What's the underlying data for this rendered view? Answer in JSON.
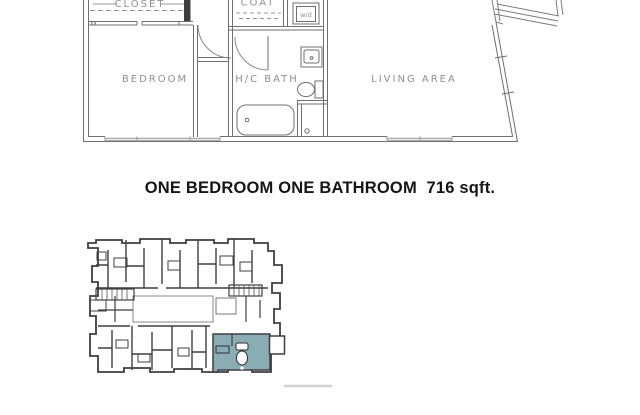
{
  "caption": {
    "title": "ONE BEDROOM ONE BATHROOM  716 sqft."
  },
  "floor_plan": {
    "labels": {
      "closet": "CLOSET",
      "coat": "COAT",
      "washer_dryer": "w/d",
      "bedroom": "BEDROOM",
      "bath": "H/C BATH",
      "living": "LIVING AREA"
    }
  },
  "colors": {
    "plan_line": "#6f6f6f",
    "light_line": "#999999",
    "label_text": "#8f8f8f",
    "keymap_line": "#3f3f3f",
    "highlight_unit": "#8aacb5",
    "background": "#ffffff"
  }
}
